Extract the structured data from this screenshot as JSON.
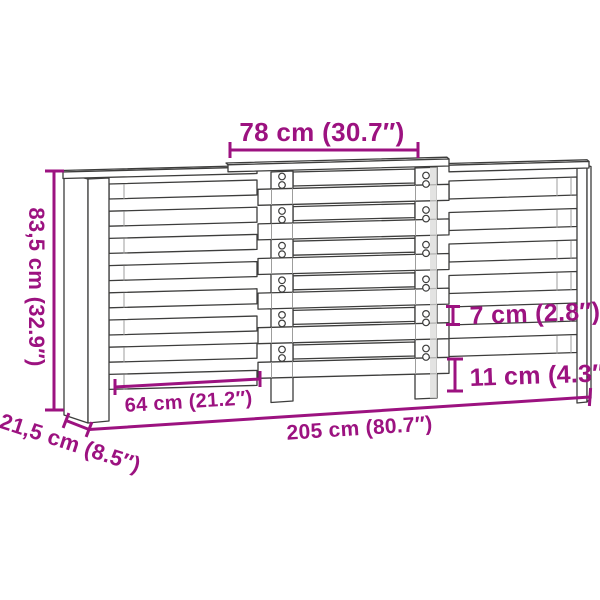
{
  "diagram": {
    "title": "radiator-cover-dimension-diagram",
    "colors": {
      "accent": "#9C1280",
      "outline": "#3d3d3c",
      "secondary_line": "#9d9d9c",
      "background": "#ffffff"
    },
    "dimensions": {
      "top_width": "78 cm (30.7″)",
      "height": "83,5 cm (32.9″)",
      "depth": "21,5 cm (8.5″)",
      "left_section_width": "64 cm (21.2″)",
      "total_width": "205 cm (80.7″)",
      "slat_height": "7 cm (2.8″)",
      "bottom_gap": "11 cm (4.3″)"
    }
  }
}
